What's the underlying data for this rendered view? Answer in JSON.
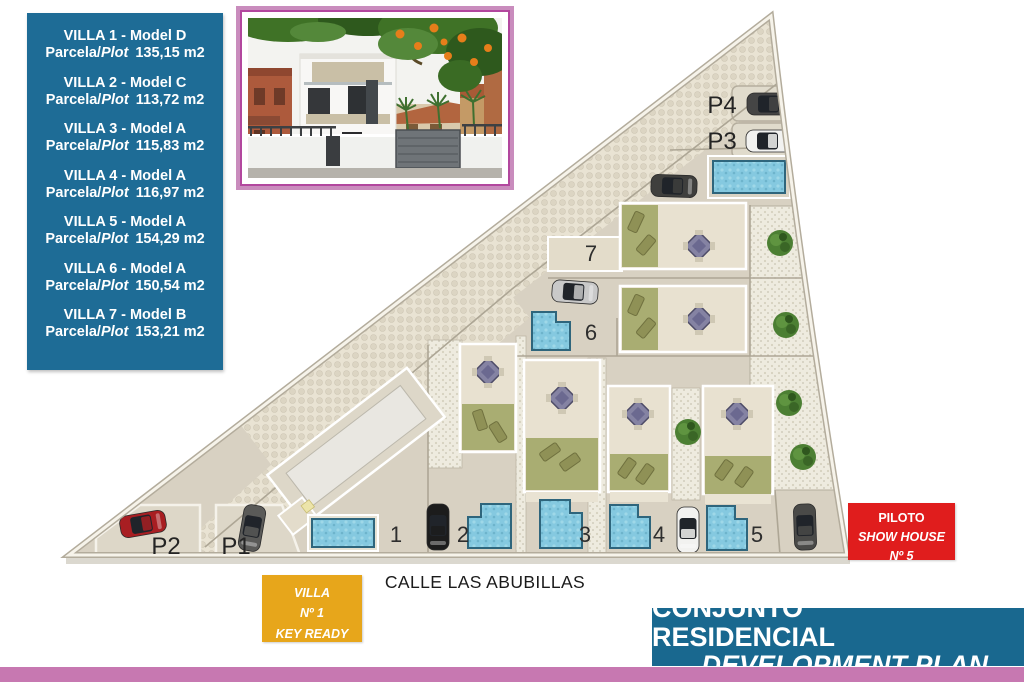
{
  "legend": {
    "parcela_prefix": "Parcela/",
    "plot_word": "Plot",
    "villas": [
      {
        "name": "VILLA 1 - Model D",
        "area": "135,15 m2"
      },
      {
        "name": "VILLA 2 - Model C",
        "area": "113,72 m2"
      },
      {
        "name": "VILLA 3 - Model A",
        "area": "115,83 m2"
      },
      {
        "name": "VILLA 4 - Model A",
        "area": "116,97 m2"
      },
      {
        "name": "VILLA 5 - Model A",
        "area": "154,29 m2"
      },
      {
        "name": "VILLA 6 - Model A",
        "area": "150,54 m2"
      },
      {
        "name": "VILLA 7 - Model B",
        "area": "153,21 m2"
      }
    ]
  },
  "plan": {
    "street_name": "CALLE LAS ABUBILLAS",
    "plot_labels": [
      "1",
      "2",
      "3",
      "4",
      "5",
      "6",
      "7"
    ],
    "parking_labels": [
      "P1",
      "P2",
      "P3",
      "P4"
    ]
  },
  "badges": {
    "key_ready": {
      "line1": "VILLA",
      "line2": "Nº 1",
      "line3": "KEY READY"
    },
    "show_house": {
      "line1": "PILOTO",
      "line2": "SHOW HOUSE",
      "line3": "Nº 5"
    }
  },
  "banner": {
    "title": "CONJUNTO RESIDENCIAL",
    "subtitle": "DEVELOPMENT PLAN"
  },
  "colors": {
    "legend_bg": "#1E6C96",
    "banner_bg": "#19688F",
    "badge_yellow_bg": "#E7A61B",
    "badge_red_bg": "#E01D1D",
    "pink_strip": "#C778B1",
    "photo_frame": "#C98CBD",
    "photo_frame_line": "#B2479E",
    "plan_ground": "#D8D1C2",
    "pool_blue": "#85C9E0",
    "lawn_green": "#A9AD72"
  }
}
